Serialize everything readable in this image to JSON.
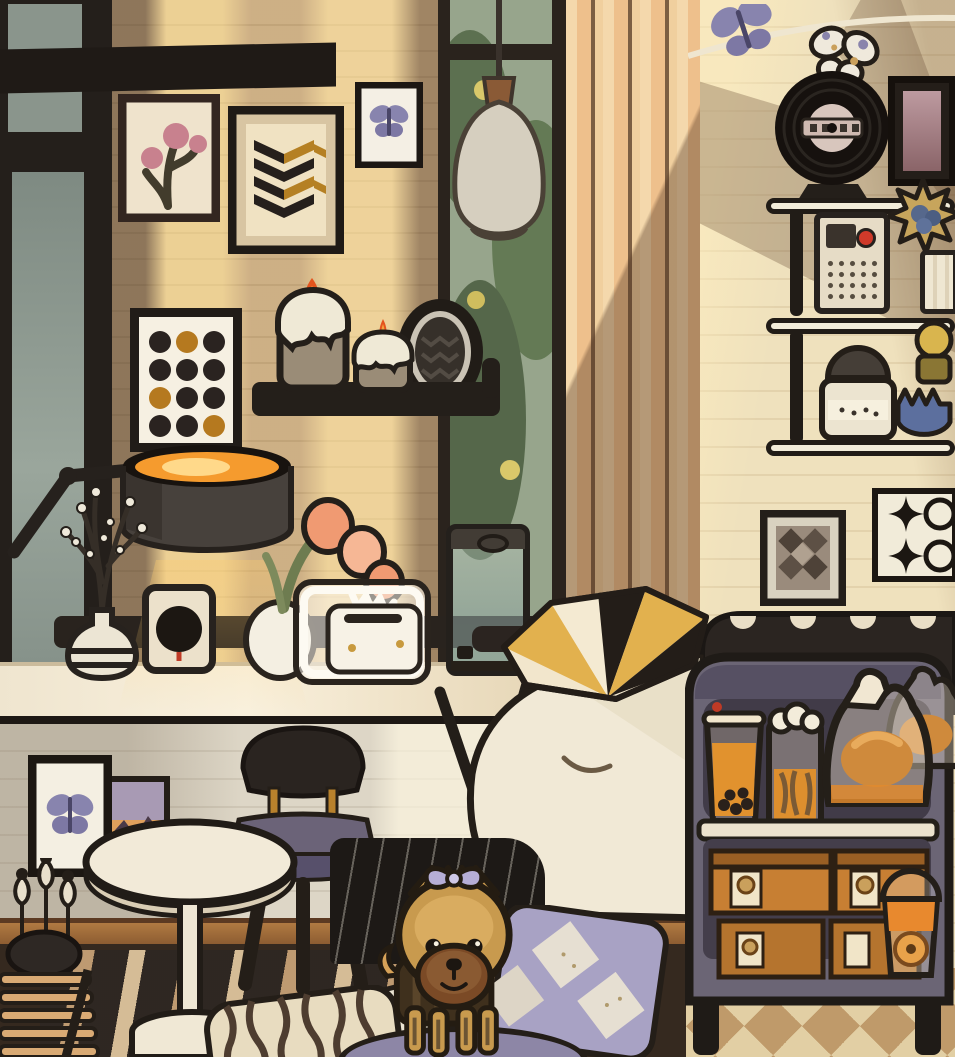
{
  "app": {
    "name": "cozy-room-game-scene",
    "description": "Toca-style illustrated bedroom at golden hour with a Yorkie puppy, wall art, candles, snack cart and shelves",
    "visible_text": []
  },
  "palette": {
    "brick_warm": "#d2b68c",
    "sunbeam": "#ffe2a0",
    "right_wall": "#ecdcb6",
    "outline_dark": "#241e18",
    "cream": "#f2ead8",
    "slate_cart": "#6b6575",
    "gold": "#e2b14e",
    "candle_flame": "#e4541e",
    "tea_amber": "#e1922e",
    "lavender": "#a8a2c4",
    "butterfly_purple": "#8884ae",
    "seat_purple": "#6b6378",
    "wood_rail": "#9a6636",
    "dog_tan": "#c89a4e",
    "dog_muzzle": "#7b4a26"
  },
  "room": {
    "walls": [
      "left-corner-window",
      "warm-brick-wall",
      "garden-window",
      "striped-curtain",
      "cream-brick-wall"
    ],
    "floor": [
      "striped-rug",
      "dark-floor",
      "checkered-floor"
    ],
    "wall_art": [
      {
        "name": "flower-art",
        "motif": "pink tulips"
      },
      {
        "name": "chevron-art",
        "motif": "black and gold herringbone"
      },
      {
        "name": "framed-butterfly-top",
        "motif": "purple butterfly"
      },
      {
        "name": "polka-dot-art",
        "motif": "3x4 dot grid, black with gold accents"
      },
      {
        "name": "oval-zigzag-frame",
        "motif": "dark zigzag oval"
      },
      {
        "name": "diamond-checker-art",
        "motif": "dark diamonds"
      },
      {
        "name": "sparkle-art",
        "motif": "black four-point stars"
      },
      {
        "name": "framed-butterfly-bottom",
        "motif": "purple butterfly"
      },
      {
        "name": "framed-sunset-photo",
        "motif": "sunset landscape"
      }
    ],
    "items": [
      {
        "name": "pendant-lamp"
      },
      {
        "name": "candle-shelf"
      },
      {
        "name": "candle-large"
      },
      {
        "name": "candle-small"
      },
      {
        "name": "desk-lamp"
      },
      {
        "name": "vase-with-branches"
      },
      {
        "name": "power-outlet"
      },
      {
        "name": "tulip-crate"
      },
      {
        "name": "water-dispenser"
      },
      {
        "name": "bed-with-blanket"
      },
      {
        "name": "headboard-polka"
      },
      {
        "name": "triangle-pillow"
      },
      {
        "name": "butterfly-garland"
      },
      {
        "name": "vinyl-record"
      },
      {
        "name": "dark-photo-frame"
      },
      {
        "name": "radio"
      },
      {
        "name": "star-ornament"
      },
      {
        "name": "ribbed-mug"
      },
      {
        "name": "cookie-jar"
      },
      {
        "name": "perfume-bottle"
      },
      {
        "name": "blue-jar"
      },
      {
        "name": "snack-cart"
      },
      {
        "name": "boba-tea-cup"
      },
      {
        "name": "cream-top-drink"
      },
      {
        "name": "bread-bags"
      },
      {
        "name": "bakery-boxes"
      },
      {
        "name": "dome-lid-drink"
      },
      {
        "name": "chair-purple-seat"
      },
      {
        "name": "round-side-table"
      },
      {
        "name": "slat-rack"
      },
      {
        "name": "dart-pot"
      },
      {
        "name": "yorkie-dog",
        "accessory": "lavender bow"
      },
      {
        "name": "striped-pillow"
      },
      {
        "name": "argyle-pillow"
      },
      {
        "name": "white-pillow"
      },
      {
        "name": "pinstripe-cushion"
      },
      {
        "name": "round-pet-bed"
      }
    ]
  }
}
